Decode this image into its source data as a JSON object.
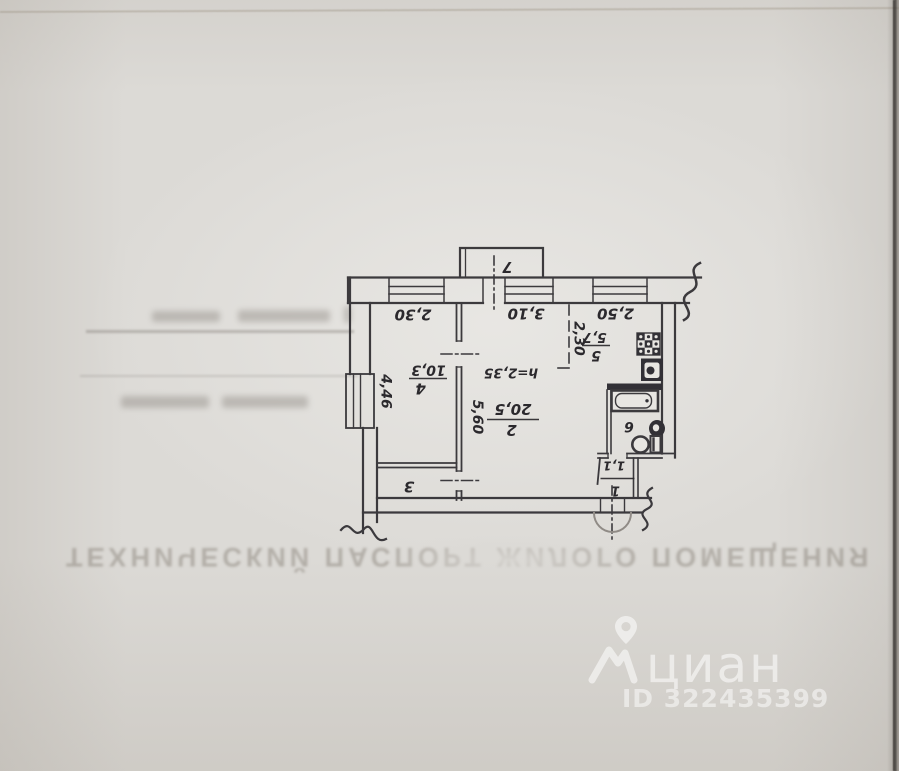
{
  "plan": {
    "rooms": [
      {
        "number": "1",
        "area": "1,1"
      },
      {
        "number": "2",
        "area": "20,5",
        "height": "h=2,35",
        "width": "3,10",
        "depth": "5,60"
      },
      {
        "number": "3"
      },
      {
        "number": "4",
        "area": "10,3",
        "width": "2,30",
        "depth": "4,46"
      },
      {
        "number": "5",
        "area": "5,7",
        "width": "2,50",
        "depth": "2,30"
      },
      {
        "number": "6"
      },
      {
        "number": "7"
      }
    ]
  },
  "bleed": {
    "title": "ТЕХНИЧЕСКИЙ ПАСПОРТ ЖИЛОГО ПОМЕЩЕНИЯ"
  },
  "watermark": {
    "brand": "циан",
    "id": "ID 322435399"
  },
  "colors": {
    "ink": "#2b292d",
    "paper": "#dcdad6"
  }
}
